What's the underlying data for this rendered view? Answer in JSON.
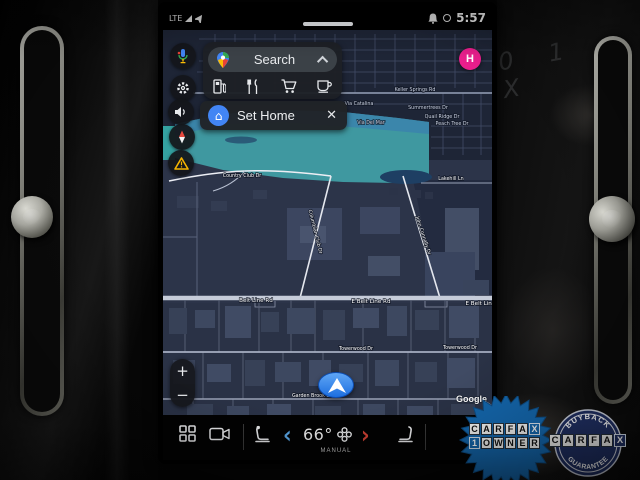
{
  "status_bar": {
    "network": "LTE",
    "time": "5:57"
  },
  "map_overlay": {
    "search_label": "Search",
    "set_home_label": "Set Home",
    "close_x": "✕",
    "zoom_in": "+",
    "zoom_out": "−",
    "home_marker": "H",
    "google": "Google"
  },
  "map_labels": {
    "keller_springs": "Keller Springs Rd",
    "summertrees": "Summertrees Dr",
    "via_catalina": "Via Catalina",
    "via_del_mar": "Via Del Mar",
    "quail_ridge": "Quail Ridge Dr",
    "peach_tree": "Peach Tree Dr",
    "country_club": "Country Club Dr",
    "columbian_club": "Columbian Club Dr",
    "john_connally": "John Connally Dr",
    "lakehill": "Lakehill Ln",
    "belt_line_1": "Belt Line Rd",
    "belt_line_2": "E Belt Line Rd",
    "belt_line_3": "E Belt Line Rd",
    "towerwood_1": "Towerwood Dr",
    "towerwood_2": "Towerwood Dr",
    "garden_brook": "Garden Brook Dr"
  },
  "climate_bar": {
    "temperature": "66°",
    "mode": "MANUAL",
    "prev": "‹",
    "next": "›"
  },
  "badges": {
    "owner": {
      "line1": "CARFAX",
      "line2": "1OWNER"
    },
    "buyback": {
      "top": "BUYBACK",
      "middle": "CARFAX",
      "bottom": "GUARANTEE"
    }
  },
  "markings": "0 1 X",
  "colors": {
    "assistant_blue": "#4285f4",
    "home_pink": "#e91e8c",
    "carfax_blue": "#1467ad",
    "carfax_navy": "#203064",
    "temp_cold": "#5aa7e8",
    "temp_hot": "#cf4134",
    "golf_teal": "#3f98a0"
  }
}
